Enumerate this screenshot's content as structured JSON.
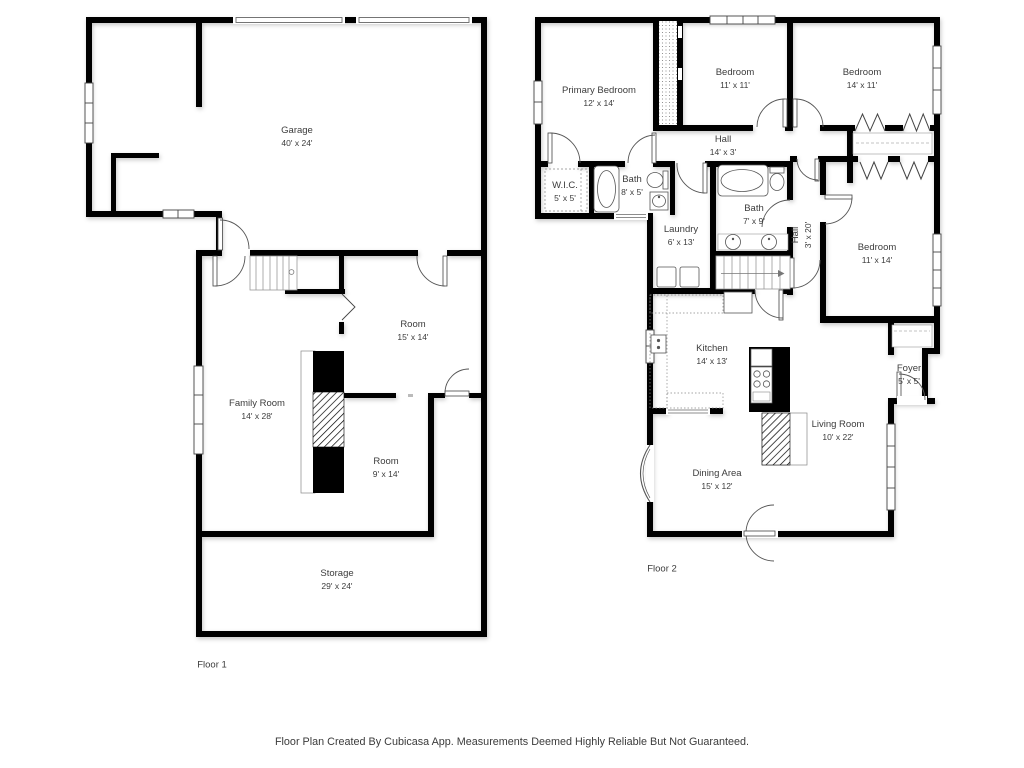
{
  "meta": {
    "footer": "Floor Plan Created By Cubicasa App. Measurements Deemed Highly Reliable But Not Guaranteed."
  },
  "floors": [
    {
      "label": "Floor 1",
      "label_x": 212,
      "label_y": 665,
      "rooms": [
        {
          "name": "Garage",
          "dims": "40' x 24'",
          "x": 297,
          "y": 137
        },
        {
          "name": "Room",
          "dims": "15' x 14'",
          "x": 413,
          "y": 331
        },
        {
          "name": "Family Room",
          "dims": "14' x 28'",
          "x": 257,
          "y": 410
        },
        {
          "name": "Room",
          "dims": "9' x 14'",
          "x": 386,
          "y": 468
        },
        {
          "name": "Storage",
          "dims": "29' x 24'",
          "x": 337,
          "y": 580
        }
      ]
    },
    {
      "label": "Floor 2",
      "label_x": 662,
      "label_y": 569,
      "rooms": [
        {
          "name": "Primary Bedroom",
          "dims": "12' x 14'",
          "x": 599,
          "y": 97
        },
        {
          "name": "Bedroom",
          "dims": "11' x 11'",
          "x": 735,
          "y": 79
        },
        {
          "name": "Bedroom",
          "dims": "14' x 11'",
          "x": 862,
          "y": 79
        },
        {
          "name": "Hall",
          "dims": "14' x 3'",
          "x": 723,
          "y": 146
        },
        {
          "name": "W.I.C.",
          "dims": "5' x 5'",
          "x": 565,
          "y": 192
        },
        {
          "name": "Bath",
          "dims": "8' x 5'",
          "x": 632,
          "y": 186
        },
        {
          "name": "Laundry",
          "dims": "6' x 13'",
          "x": 681,
          "y": 236
        },
        {
          "name": "Bath",
          "dims": "7' x 9'",
          "x": 754,
          "y": 215
        },
        {
          "name": "Hall",
          "dims": "3' x 20'",
          "x": 802,
          "y": 235,
          "rotate": -90
        },
        {
          "name": "Bedroom",
          "dims": "11' x 14'",
          "x": 877,
          "y": 254
        },
        {
          "name": "Kitchen",
          "dims": "14' x 13'",
          "x": 712,
          "y": 355
        },
        {
          "name": "Living Room",
          "dims": "10' x 22'",
          "x": 838,
          "y": 431
        },
        {
          "name": "Dining Area",
          "dims": "15' x 12'",
          "x": 717,
          "y": 480
        },
        {
          "name": "Foyer",
          "dims": "5' x 5'",
          "x": 909,
          "y": 375
        }
      ]
    }
  ]
}
